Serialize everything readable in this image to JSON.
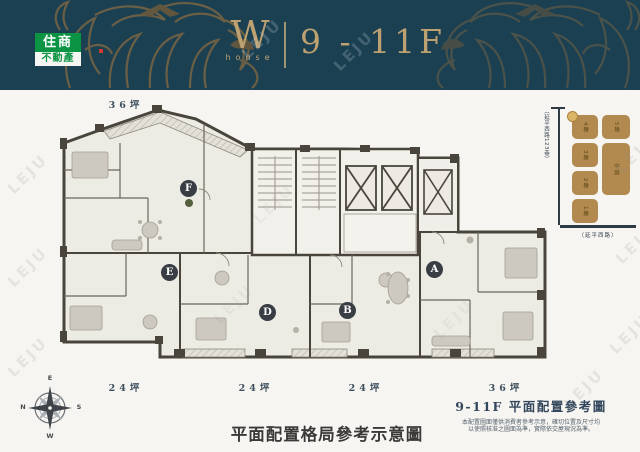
{
  "header": {
    "brand_top": "住商",
    "brand_bottom": "不動產",
    "mark": "W",
    "mark_sub": "house",
    "floors": "9 - 11F"
  },
  "plan": {
    "area_top": "36坪",
    "area_b1": "24坪",
    "area_b2": "24坪",
    "area_b3": "24坪",
    "area_b4": "36坪",
    "units": {
      "a": "A",
      "b": "B",
      "d": "D",
      "e": "E",
      "f": "F"
    }
  },
  "site_map": {
    "street_lane": "（延平西路123巷）",
    "street_main": "（延平西路）",
    "blocks": {
      "b4": "4棟",
      "b3": "3棟",
      "b2": "2棟",
      "b1": "1棟",
      "b5": "5棟",
      "court": "中庭"
    }
  },
  "compass": {
    "n": "N",
    "e": "E",
    "s": "S",
    "w": "W"
  },
  "footer": {
    "title_right": "9-11F 平面配置參考圖",
    "note_line1": "本配置圖面僅供消費者參考示意，確切位置及尺寸均",
    "note_line2": "以使照核准之圖面為準，實際依交屋現況為準。",
    "title_center": "平面配置格局參考示意圖"
  },
  "watermark": "LEJU",
  "colors": {
    "header_bg": "#1b4052",
    "gold": "#bda171",
    "ornament": "#8a6b41",
    "brand_green": "#0a9444",
    "wall": "#49453d",
    "navy": "#32465c",
    "site_brown": "#b28a50"
  }
}
